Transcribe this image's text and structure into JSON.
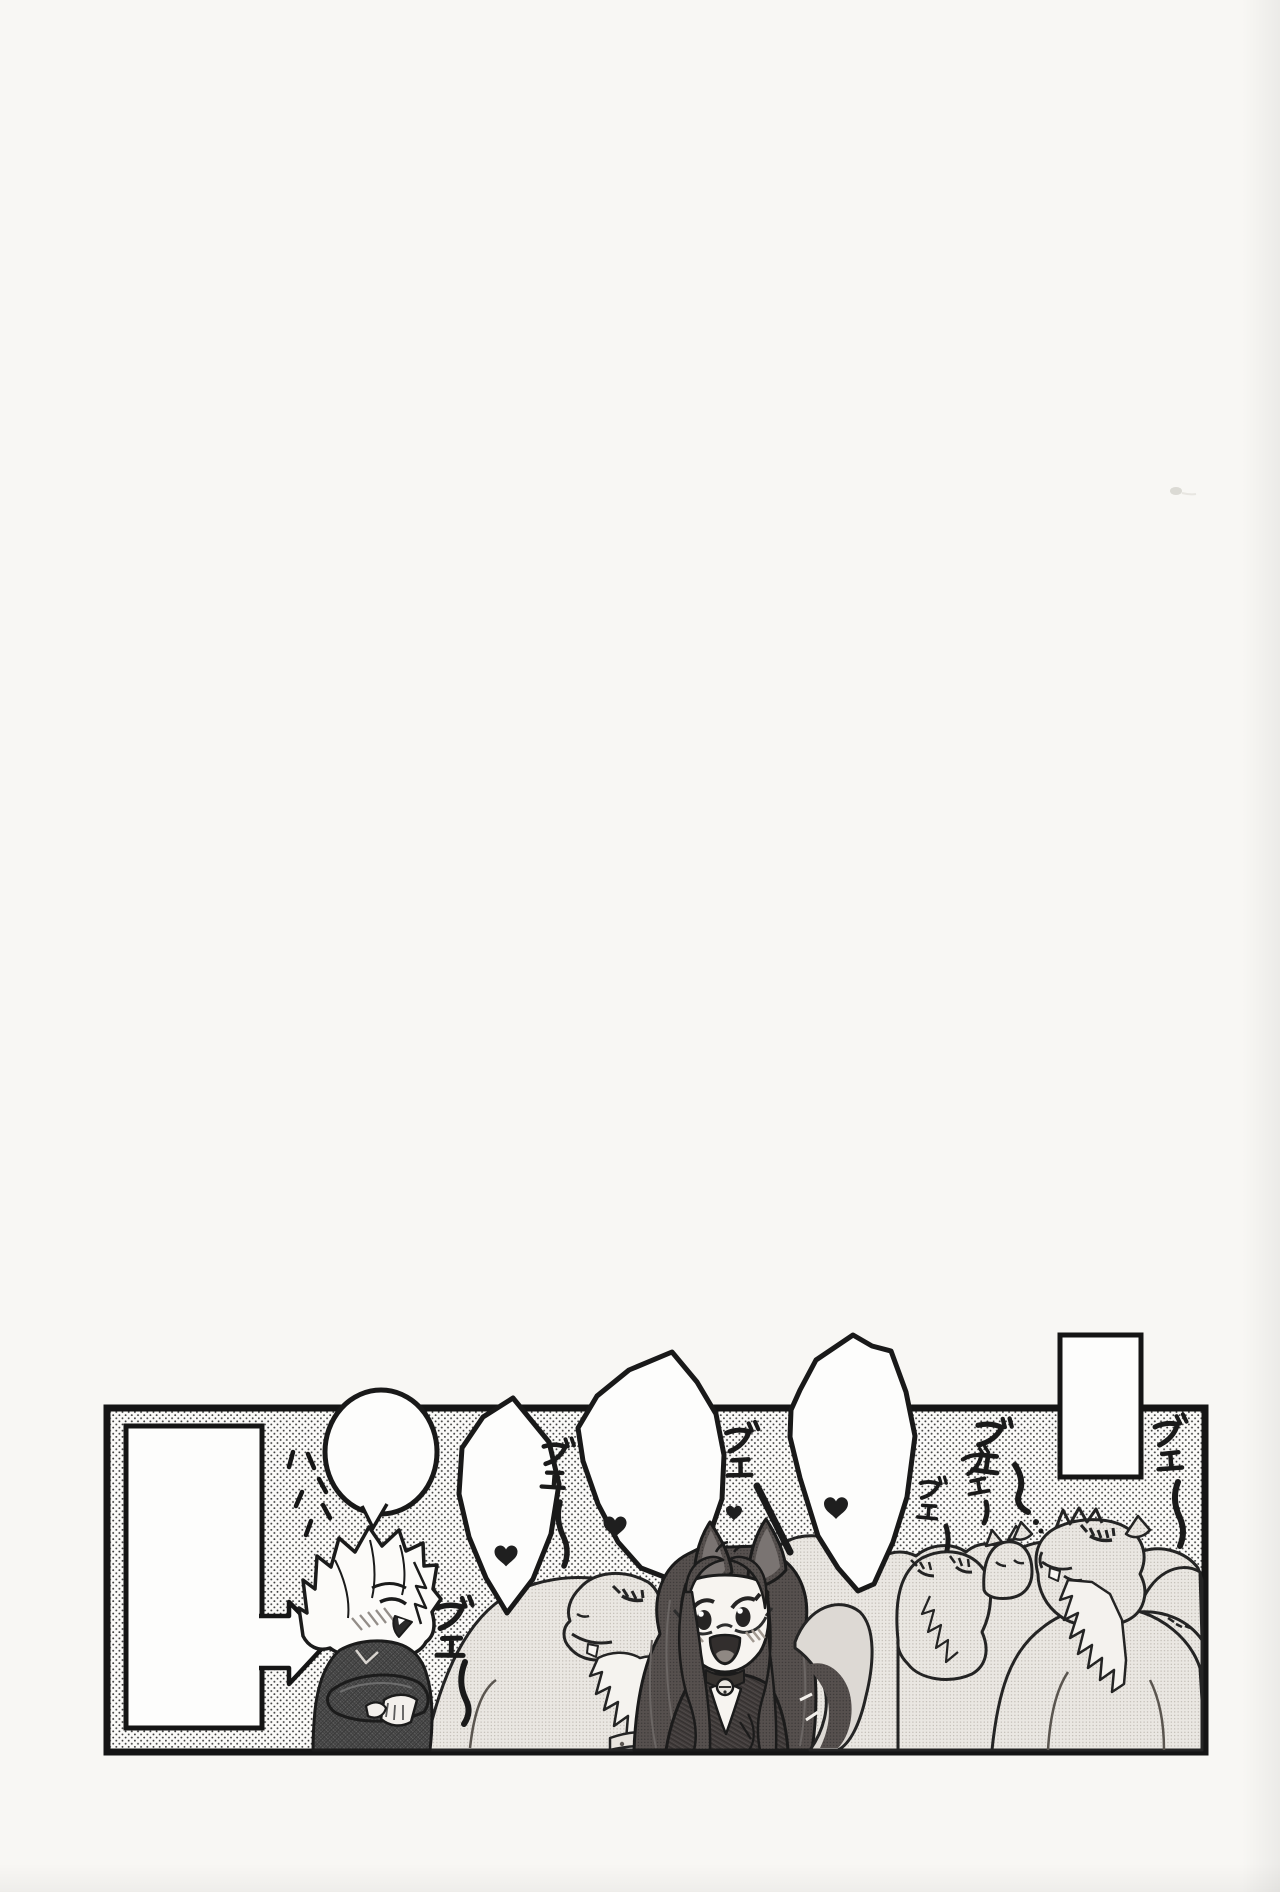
{
  "page": {
    "kind": "scanned manga doujinshi page, mostly blank with one omake comic strip near the bottom",
    "background_color": "#f8f7f4",
    "ink_color": "#1a1a1a",
    "scan_speck": "faint gray speck near upper right"
  },
  "panel": {
    "background": "white with black polka-dot screentone",
    "caption_box_left": "",
    "caption_box_top_right": "",
    "arrow": {
      "shape": "right-pointing block arrow",
      "points_at": "chibi boy"
    }
  },
  "balloons": [
    {
      "shape": "round balloon with tail toward chibi boy",
      "content": ""
    },
    {
      "shape": "angular balloon",
      "content": "♥"
    },
    {
      "shape": "angular balloon",
      "content": "♥"
    },
    {
      "shape": "angular balloon",
      "content": "♥"
    }
  ],
  "hearts": {
    "symbol": "♥",
    "in_balloons": 3,
    "floating": 3
  },
  "sfx": {
    "laugh_marks": "ハハ",
    "camel_cries": [
      "ブェ〜",
      "ブェ〜",
      "ブェ〜",
      "ブェ〜",
      "ブェ〜",
      "ブェ〜",
      "ブェ〜"
    ]
  },
  "characters": {
    "boy": "chibi boy with light spiky hair, dark plaid suit, arms crossed, eyes closed laughing, blushing",
    "girl": "girl with tall animal ears, long dark wavy hair, under-rim glasses, bell choker, open-mouth smile, fluffy tail",
    "camels": "herd of content camels with closed eyes and long lashes surrounding the girl"
  }
}
